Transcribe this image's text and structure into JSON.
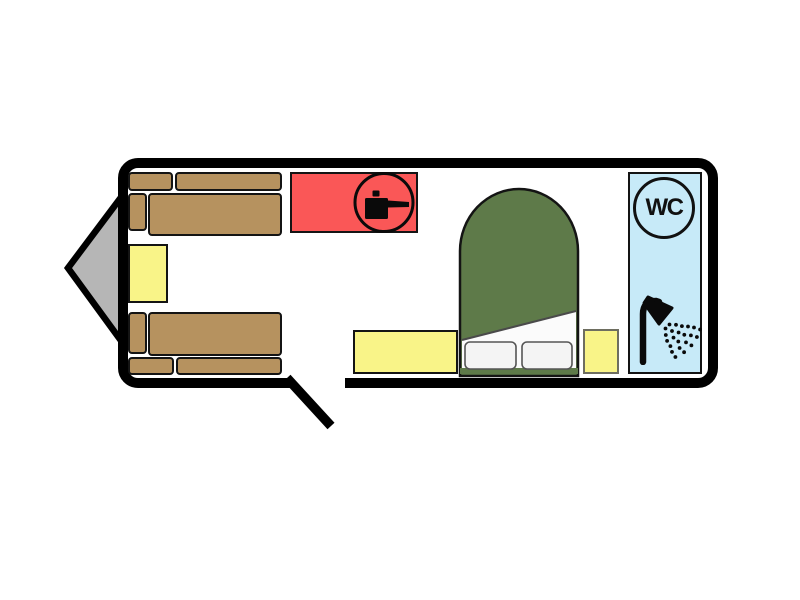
{
  "floorplan": {
    "name": "caravan-floorplan",
    "bathroom": {
      "wc_label": "WC"
    },
    "icons": {
      "kitchen": "cooking-pot-icon",
      "bathroom_wc": "wc-badge-icon",
      "bathroom_shower": "shower-icon"
    },
    "colors": {
      "outline": "#000000",
      "sofa": "#b6925f",
      "cabinet": "#f9f488",
      "kitchen": "#fa5757",
      "bed": "#5e7a49",
      "bathroom": "#c7eaf8",
      "hitch": "#b6b6b6",
      "blanket": "#fbfbfb",
      "pillow": "#f4f4f4",
      "background": "#ffffff"
    }
  }
}
